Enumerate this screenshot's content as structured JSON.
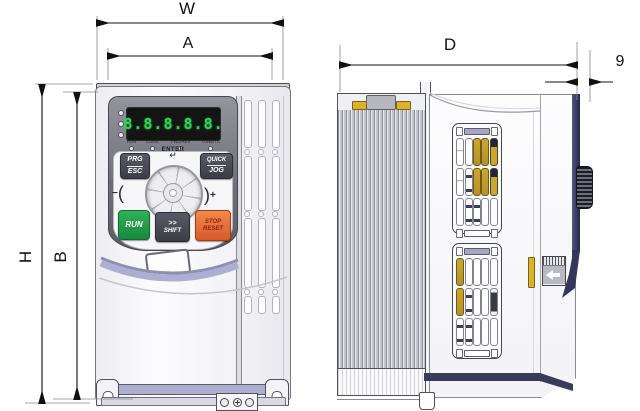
{
  "title": "inverter-dimension-drawing",
  "dimensions": {
    "w": "W",
    "a": "A",
    "d": "D",
    "knob": "9",
    "h": "H",
    "b": "B"
  },
  "keypad": {
    "display_value": "8.8.8.8.8.",
    "indicators": [
      "RUN",
      "LO/RE",
      "FWD/REV",
      "TUNE/TC"
    ],
    "btn_prg_line1": "PRG",
    "btn_prg_line2": "ESC",
    "enter_label": "ENTER",
    "enter_symbol": "↵",
    "btn_quick_line1": "QUICK",
    "btn_quick_line2": "JOG",
    "btn_run": "RUN",
    "btn_shift_line1": ">>",
    "btn_shift_line2": "SHIFT",
    "btn_stop_line1": "STOP",
    "btn_stop_line2": "RESET",
    "dial_minus_sign": "−",
    "dial_minus_paren": "(",
    "dial_plus_paren": ")",
    "dial_plus_sign": "+"
  },
  "colors": {
    "display_green": "#2ed657",
    "run_green": "#1f9e4a",
    "stop_orange": "#e2673a",
    "accent_lavender": "#aeaed0",
    "gold": "#cba72f",
    "navy": "#3a3a5c",
    "dim_line": "#1a1a1a"
  }
}
